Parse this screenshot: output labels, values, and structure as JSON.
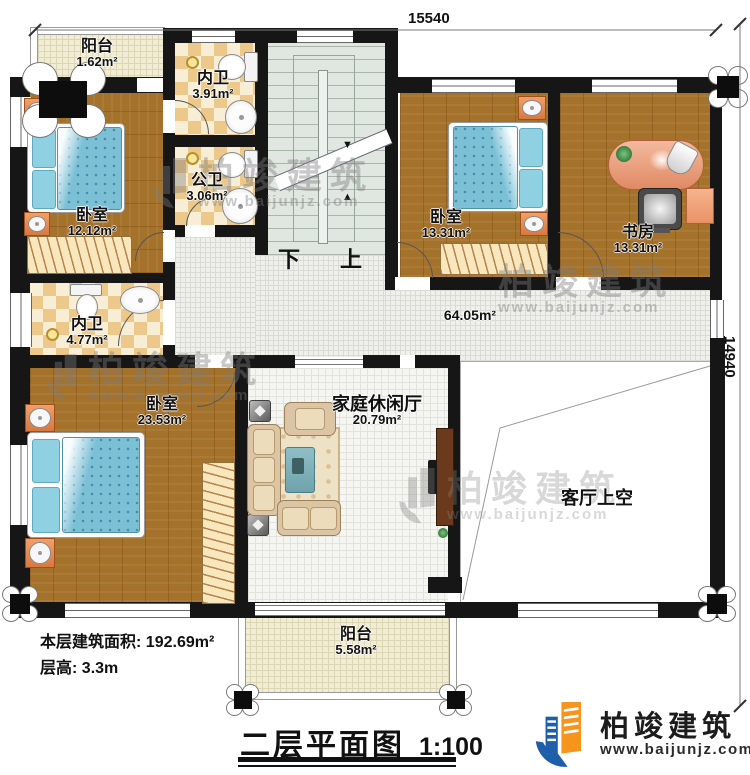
{
  "dims": {
    "top": "15540",
    "right": "14940"
  },
  "rooms": [
    {
      "id": "balcony-top",
      "name": "阳台",
      "area": "1.62m²"
    },
    {
      "id": "bath-inner-1",
      "name": "内卫",
      "area": "3.91m²"
    },
    {
      "id": "bath-public",
      "name": "公卫",
      "area": "3.06m²"
    },
    {
      "id": "bedroom-1",
      "name": "卧室",
      "area": "12.12m²"
    },
    {
      "id": "bedroom-2",
      "name": "卧室",
      "area": "13.31m²"
    },
    {
      "id": "study",
      "name": "书房",
      "area": "13.31m²"
    },
    {
      "id": "bath-inner-2",
      "name": "内卫",
      "area": "4.77m²"
    },
    {
      "id": "bedroom-3",
      "name": "卧室",
      "area": "23.53m²"
    },
    {
      "id": "family-hall",
      "name": "家庭休闲厅",
      "area": "20.79m²"
    },
    {
      "id": "hallway",
      "name": "",
      "area": "64.05m²"
    },
    {
      "id": "living-void",
      "name": "客厅上空",
      "area": ""
    },
    {
      "id": "balcony-bottom",
      "name": "阳台",
      "area": "5.58m²"
    }
  ],
  "stairs": {
    "down": "下",
    "up": "上"
  },
  "info": {
    "area_label": "本层建筑面积:",
    "area_value": "192.69m²",
    "height_label": "层高:",
    "height_value": "3.3m"
  },
  "title": {
    "text": "二层平面图",
    "scale": "1:100"
  },
  "brand": {
    "name": "柏竣建筑",
    "url": "www.baijunjz.com"
  },
  "watermark": {
    "name": "柏竣建筑",
    "url": "www.baijunjz.com"
  },
  "colors": {
    "wall": "#161616",
    "wood": "#a5722c",
    "tile": "#efefec",
    "checker_a": "#ecc98b",
    "checker_b": "#f8eed6",
    "balcony": "#f1edd5",
    "stairs": "#e0e6e0",
    "bed": "#7cc0d6",
    "accent_orange": "#e08850",
    "logo_blue": "#1d5fa8",
    "logo_orange": "#f7941d"
  }
}
